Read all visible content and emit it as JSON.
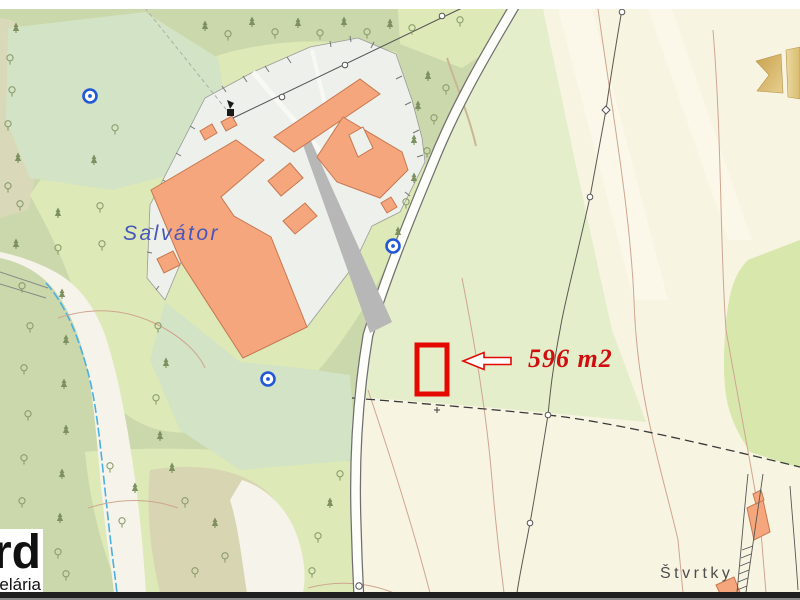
{
  "map": {
    "title": "Cadastral map with highlighted parcel",
    "labels": {
      "settlement": "Salvátor",
      "parcel_area": "596 m2",
      "locality": "Štvrtky"
    },
    "parcel": {
      "area_value": "596 m2",
      "highlight_color": "#e50800"
    },
    "watermark_logo": {
      "line1": "rd",
      "line2": "elária"
    },
    "colors": {
      "field": "#f8f4e2",
      "forest": "#cbd8ab",
      "meadow": "#d3e3c5",
      "orchard_dotted": "#dde9b6",
      "pale_crop": "#e4eecb",
      "building": "#f5a67c",
      "building_outline": "#c8784e",
      "compound": "#eef0ec",
      "road_fill": "#fdfdfa",
      "water": "#49b0e3",
      "contour": "#cfa58f",
      "parcel_outline": "#e50800",
      "label_blue": "#4656bb",
      "label_gray": "#4d4d4d",
      "gold": "#d2ab5c"
    },
    "icons": {
      "spring": "spring-icon",
      "monument": "monument-icon",
      "power_pole": "power-pole-icon",
      "tree_deciduous": "deciduous-tree-icon",
      "tree_conifer": "conifer-tree-icon",
      "arrow": "parcel-pointer-arrow-icon",
      "ribbon": "gold-ribbon-icon"
    }
  }
}
